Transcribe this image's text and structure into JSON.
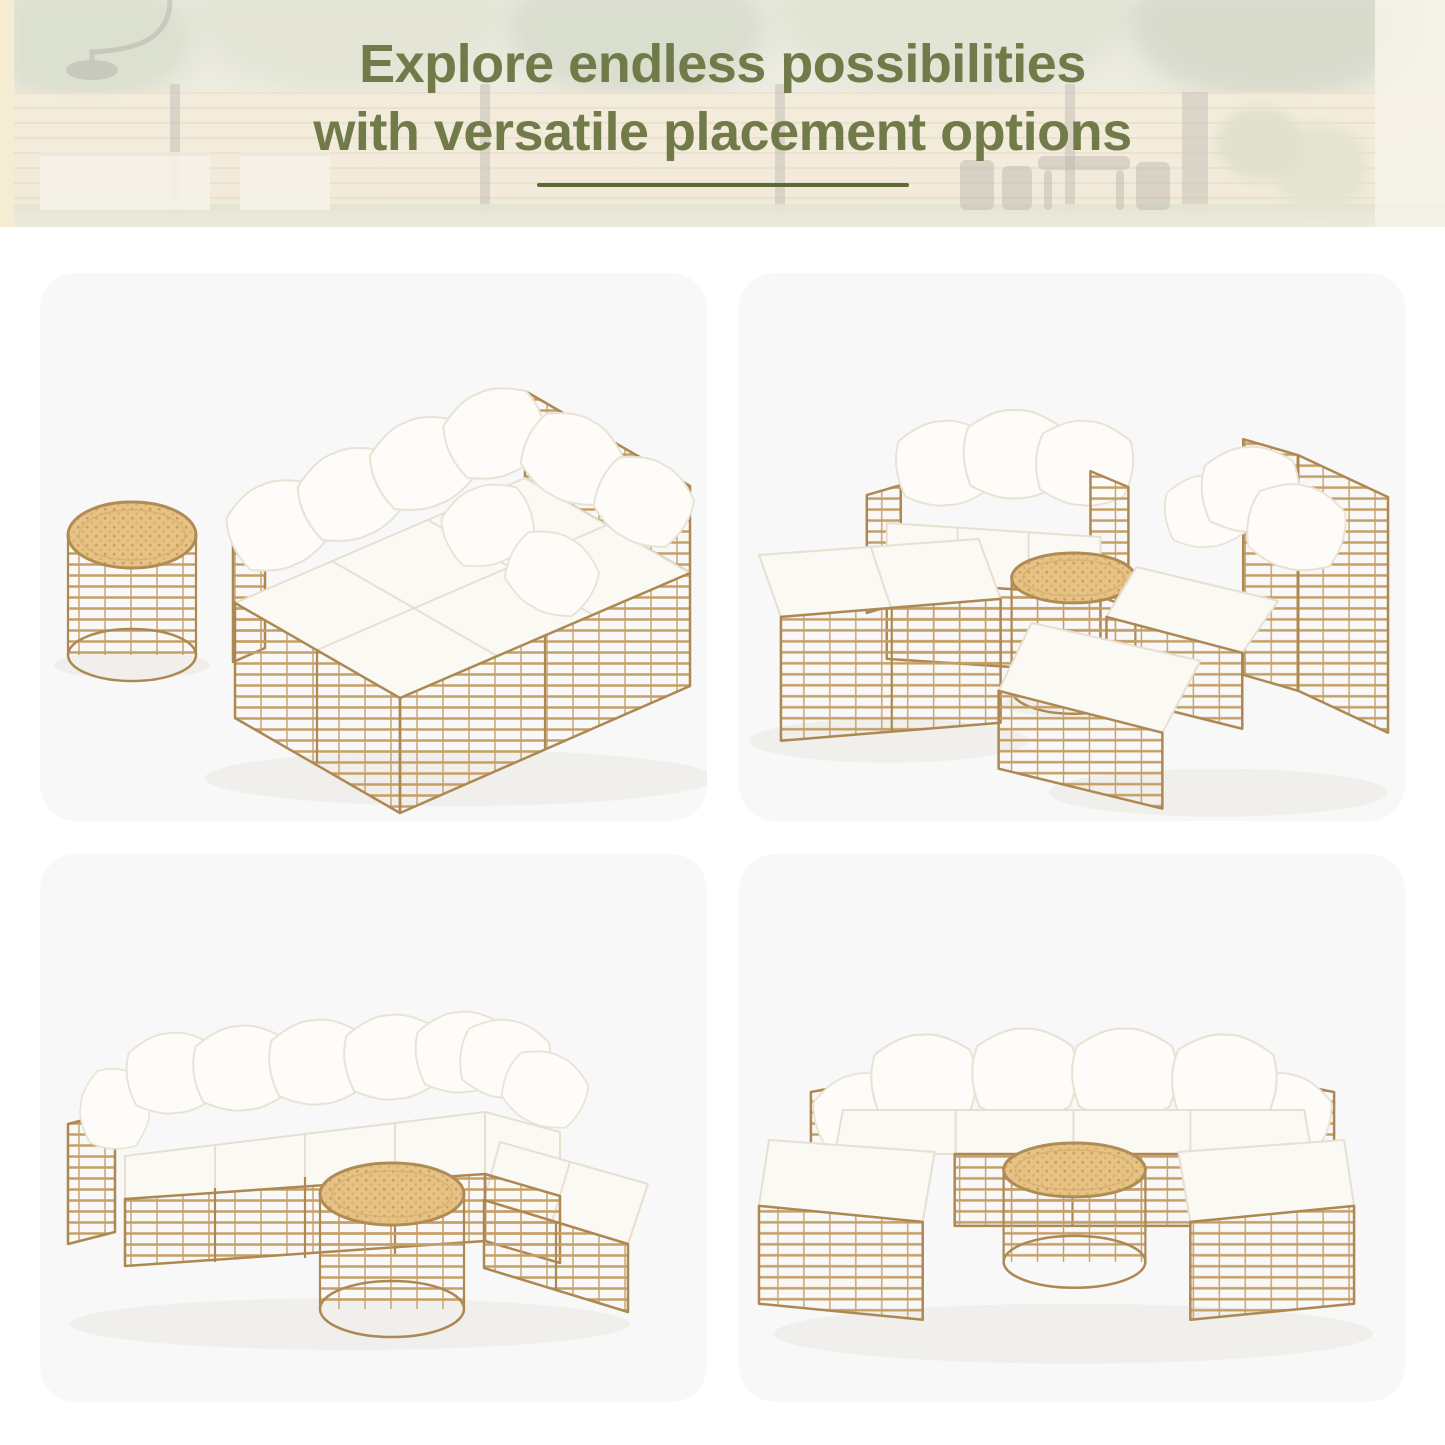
{
  "header": {
    "title_line1": "Explore endless possibilities",
    "title_line2": "with versatile placement options"
  },
  "colors": {
    "title_color": "#717b49",
    "divider_color": "#5c6a36",
    "page_bg": "#ffffff",
    "card_bg": "#f8f8f8",
    "rattan": "#c69f67",
    "rattan_outline": "#ad8852",
    "cushion": "#fbf9f4",
    "cushion_outline": "#e7e0d1",
    "table_top": "#e7c285"
  },
  "gallery": {
    "photos": [
      {
        "name": "daybed-with-side-table"
      },
      {
        "name": "sofa-chaise-and-corner-chairs-with-coffee-table"
      },
      {
        "name": "l-shaped-sectional-with-coffee-table"
      },
      {
        "name": "u-shaped-sectional-with-coffee-table"
      }
    ]
  }
}
